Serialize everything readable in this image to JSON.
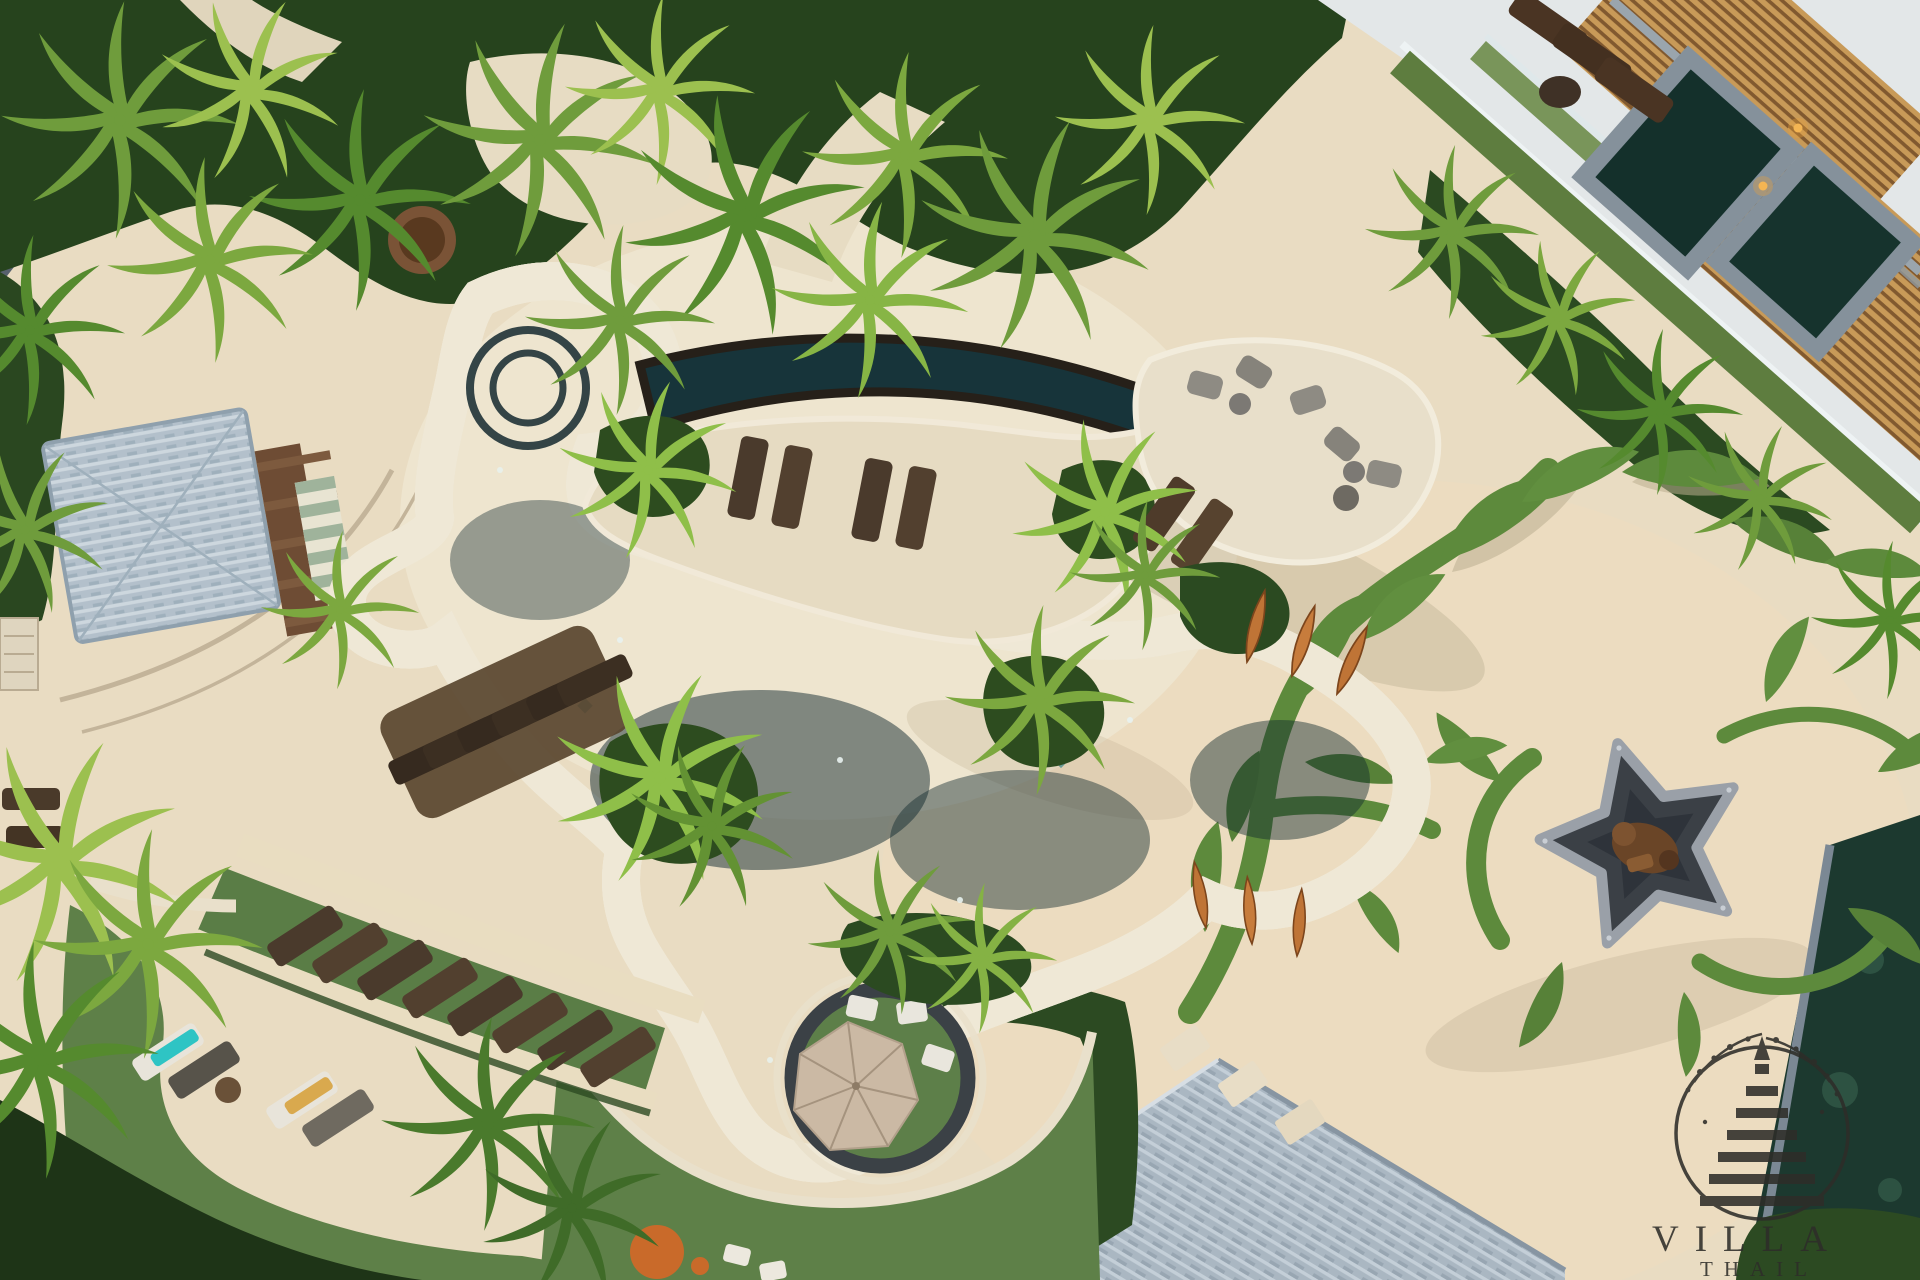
{
  "scene": {
    "kind": "aerial drone photograph",
    "subject": "Free-form tropical resort swimming pool with landscaped decks, lawns, palm trees and a leaf-motif paved terrace at dusk",
    "setting_hint": "Thailand resort"
  },
  "watermark": {
    "brand_text": "VILLA",
    "secondary_text": "THAIL",
    "emblem": "stupa-in-circle with branch sprigs"
  },
  "palette": {
    "pavement": "#e9dcc2",
    "pavement_light": "#f0e8d6",
    "pool_water": "#17343a",
    "pool_stone": "#262019",
    "coping": "#efe8d6",
    "lawn": "#5e8048",
    "turf_dark": "#4e713c",
    "foliage_dark": "#24401c",
    "palm_light": "#9cc04f",
    "palm_mid": "#6f9c3c",
    "roof_gray": "#aab7c2",
    "wood_slat": "#c89a58",
    "wood_dark": "#5a4330",
    "torch_orange": "#bf7436",
    "medallion_slate": "#3b4046",
    "medallion_rim": "#9aa0a8",
    "vine_green": "#5d8a3c",
    "street": "#57616d",
    "glass": "#cfe3ea",
    "umbrella": "#cbb9a4",
    "towel_teal": "#2ec4c4",
    "towel_yellow": "#d9a94e",
    "watermark_ink": "#2e2d29"
  }
}
